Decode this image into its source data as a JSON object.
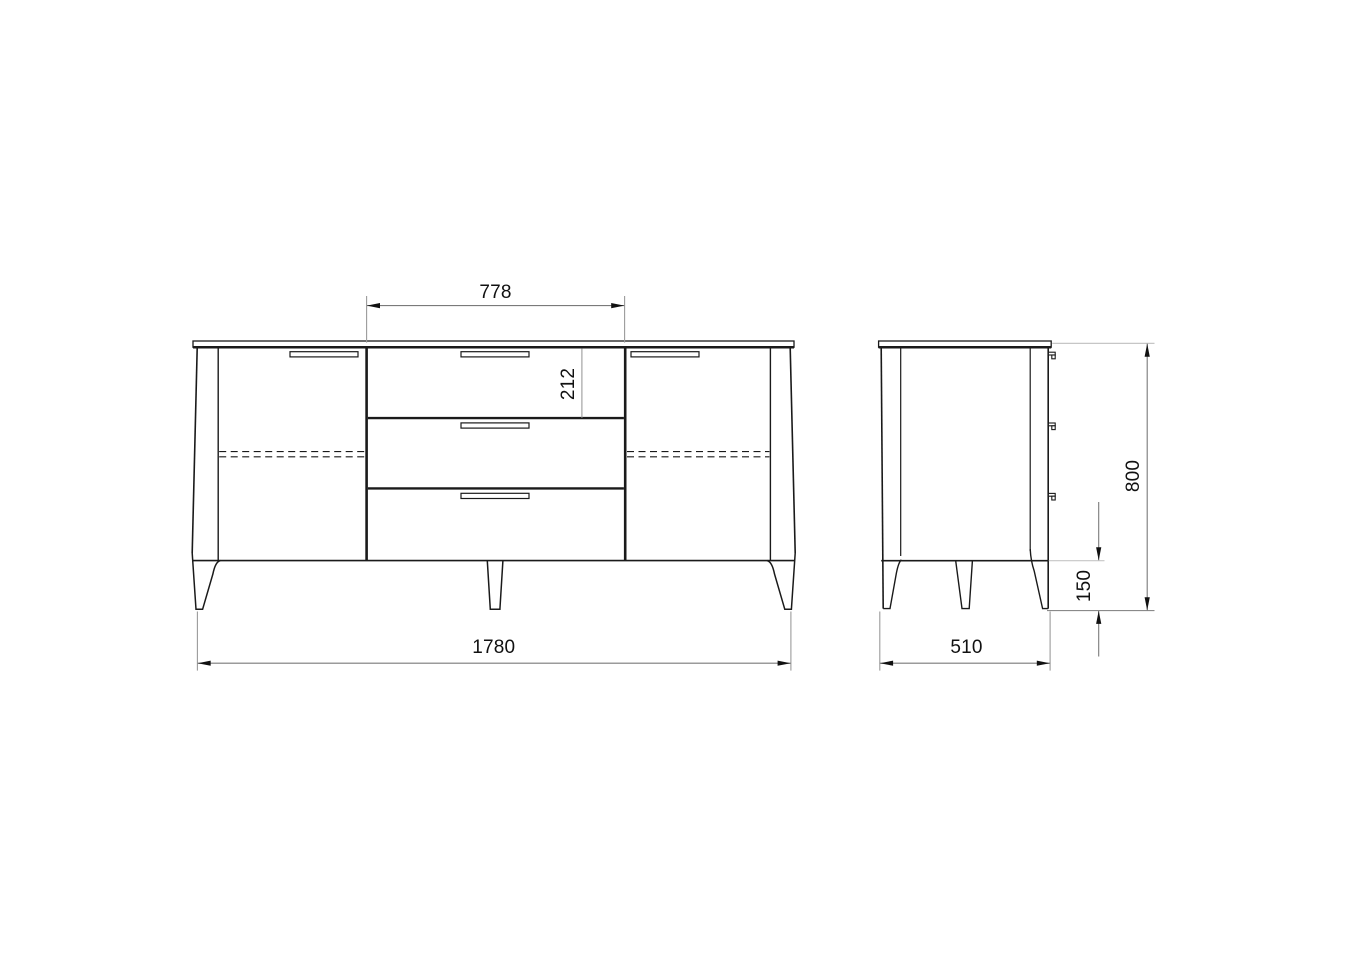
{
  "drawing": {
    "views": {
      "front": {
        "dimensions": {
          "drawer_section_width": {
            "label": "778"
          },
          "top_drawer_height": {
            "label": "212"
          },
          "overall_width": {
            "label": "1780"
          }
        }
      },
      "side": {
        "dimensions": {
          "overall_height": {
            "label": "800"
          },
          "leg_height": {
            "label": "150"
          },
          "depth": {
            "label": "510"
          }
        }
      }
    },
    "colors": {
      "outline": "#1a1a1a",
      "dimension_line": "#7a7a7a",
      "extension_line": "#9a9a9a",
      "extension_line_light": "#c6c6c6",
      "label_text": "#111111",
      "background": "#ffffff"
    }
  }
}
